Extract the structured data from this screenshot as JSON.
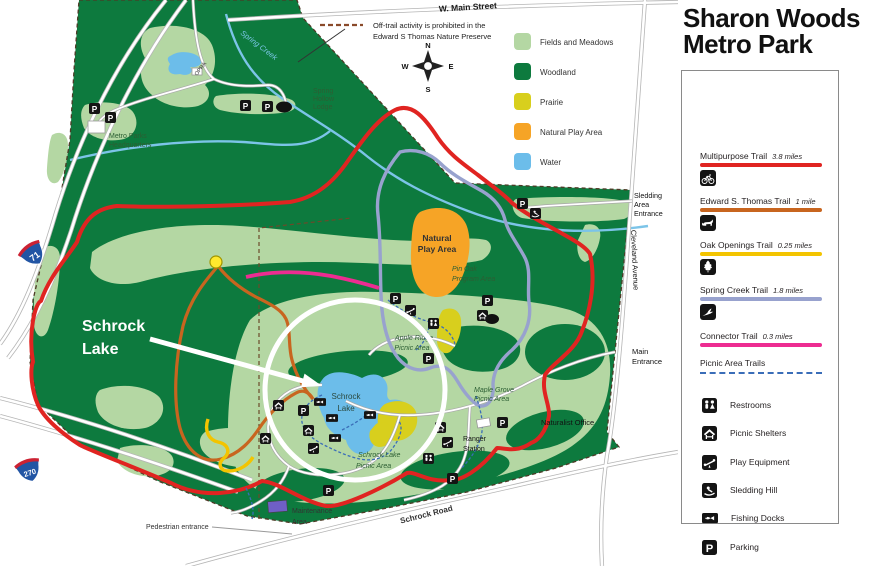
{
  "panel": {
    "title_line1": "Sharon Woods",
    "title_line2": "Metro Park",
    "trails": [
      {
        "name": "Multipurpose Trail",
        "distance": "3.8 miles",
        "color": "#e02421",
        "icon": "bike-icon"
      },
      {
        "name": "Edward S. Thomas Trail",
        "distance": "1 mile",
        "color": "#c8651f",
        "icon": "fox-icon"
      },
      {
        "name": "Oak Openings Trail",
        "distance": "0.25 miles",
        "color": "#f3c400",
        "icon": "oak-leaf-icon"
      },
      {
        "name": "Spring Creek Trail",
        "distance": "1.8 miles",
        "color": "#98a2ce",
        "icon": "bird-icon"
      },
      {
        "name": "Connector Trail",
        "distance": "0.3 miles",
        "color": "#ed2c91",
        "icon": null
      }
    ],
    "picnic_trails": {
      "name": "Picnic Area Trails",
      "color": "#3a6db8"
    },
    "facilities": [
      {
        "name": "Restrooms",
        "icon": "restrooms-icon"
      },
      {
        "name": "Picnic Shelters",
        "icon": "picnic-shelter-icon"
      },
      {
        "name": "Play Equipment",
        "icon": "play-equipment-icon"
      },
      {
        "name": "Sledding Hill",
        "icon": "sledding-icon"
      },
      {
        "name": "Fishing Docks",
        "icon": "fishing-icon"
      },
      {
        "name": "Parking",
        "icon": "parking-icon"
      },
      {
        "name": "Observation Deck",
        "icon": "observation-deck-icon"
      }
    ]
  },
  "map": {
    "land_legend": [
      {
        "name": "Fields and Meadows",
        "color": "#b4d7a3"
      },
      {
        "name": "Woodland",
        "color": "#0d7a3e"
      },
      {
        "name": "Prairie",
        "color": "#d8cf1d"
      },
      {
        "name": "Natural Play Area",
        "color": "#f6a426"
      },
      {
        "name": "Water",
        "color": "#6cbdea"
      }
    ],
    "note_line1": "Off-trail activity is prohibited in the",
    "note_line2": "Edward S Thomas Nature Preserve",
    "compass": {
      "n": "N",
      "s": "S",
      "e": "E",
      "w": "W"
    },
    "streets": {
      "w_main": "W. Main Street",
      "cleveland": "Cleveland Avenue",
      "schrock_road": "Schrock Road",
      "i71": "71",
      "i270": "270"
    },
    "entrances": {
      "sledding_1": "Sledding",
      "sledding_2": "Area",
      "sledding_3": "Entrance",
      "main_1": "Main",
      "main_2": "Entrance",
      "pedestrian": "Pedestrian entrance"
    },
    "places": {
      "spring_creek": "Spring Creek",
      "lodge_1": "Spring",
      "lodge_2": "Hollow",
      "lodge_3": "Lodge",
      "opra": "OPRA",
      "hq_1": "Metro Parks",
      "hq_2": "Headquarters",
      "npa_1": "Natural",
      "npa_2": "Play Area",
      "pinoak_1": "Pin Oak",
      "pinoak_2": "Program Area",
      "apple_1": "Apple Ridge",
      "apple_2": "Picnic Area",
      "maple_1": "Maple Grove",
      "maple_2": "Picnic Area",
      "lake_1": "Schrock",
      "lake_2": "Lake",
      "lakepicnic_1": "Schrock Lake",
      "lakepicnic_2": "Picnic Area",
      "ranger_1": "Ranger",
      "ranger_2": "Station",
      "naturalist": "Naturalist Office",
      "maint_1": "Maintenance",
      "maint_2": "Area"
    },
    "annotation": {
      "label_1": "Schrock",
      "label_2": "Lake"
    }
  }
}
